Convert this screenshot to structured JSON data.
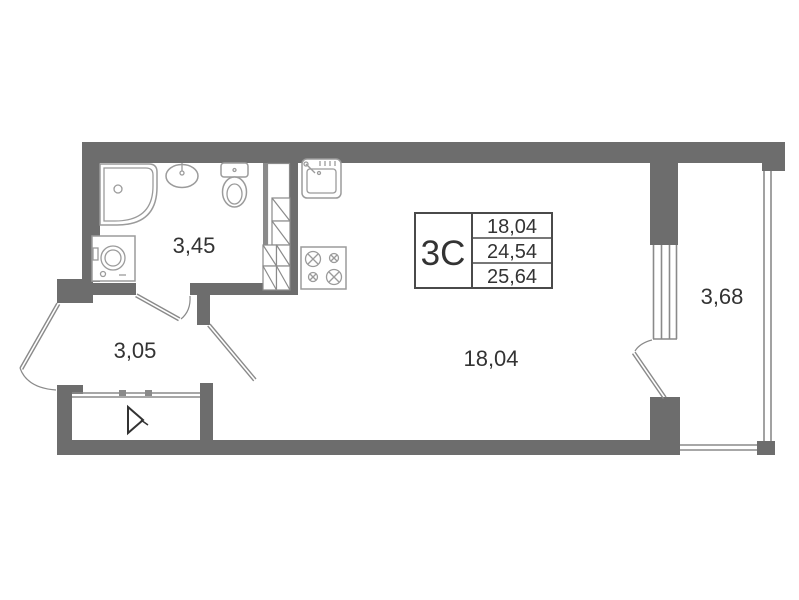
{
  "meta": {
    "type": "apartment floor plan",
    "unit_kind": "studio"
  },
  "colors": {
    "background": "#ffffff",
    "wall": "#6d6d6d",
    "thin": "#8a8a8a",
    "fixture": "#9b9b9b",
    "text": "#333333",
    "table-border": "#4a4a4a"
  },
  "labels": {
    "bathroom_area": "3,45",
    "hallway_area": "3,05",
    "living_room_area": "18,04",
    "balcony_area": "3,68"
  },
  "area_table": {
    "unit_code": "3С",
    "rows": [
      "18,04",
      "24,54",
      "25,64"
    ]
  }
}
